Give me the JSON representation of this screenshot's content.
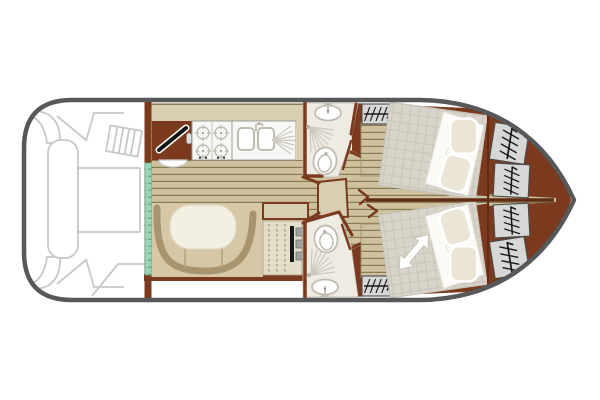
{
  "meta": {
    "title": "Canal boat deck floor plan",
    "view": "top-down",
    "orientation": "bow-right",
    "canvas_width": 600,
    "canvas_height": 400,
    "viewbox": "0 0 600 400"
  },
  "colors": {
    "hull": "#57585a",
    "deck_line": "#c8c8c8",
    "wood": "#7b3a1e",
    "wood_dark": "#5f2b13",
    "floor": "#cdc19e",
    "floor_line": "#7a6f49",
    "teal": "#97d6b8",
    "teal_line": "#3c6e58",
    "backsplash": "#d9cdb2",
    "counter": "#f7f7f5",
    "counter_line": "#9c9c98",
    "fixture": "#c0bcb0",
    "ray": "#cdc9bd",
    "bath": "#efebe3",
    "bench": "#d6c8a7",
    "bench_shadow": "#a8946e",
    "table": "#f3f0e2",
    "table_line": "#ddd6c0",
    "mattress": "#d8d4ca",
    "mattress_line": "#c6c2b8",
    "duvet": "#fbfaf6",
    "pillow": "#ebe5d5",
    "wardrobe": "#d7d7d5",
    "glyph": "#1a1a1a",
    "arrow_edge": "#ccc7ba",
    "white": "#ffffff"
  },
  "areas": {
    "aft_deck": {
      "name": "Aft deck cockpit",
      "features": [
        "corner seat top",
        "corner seat bottom",
        "long bench seat",
        "cockpit table",
        "boarding steps",
        "transom lines"
      ]
    },
    "sliding_door": {
      "name": "Sliding patio door",
      "color_key": "teal"
    },
    "galley": {
      "name": "Galley / helm",
      "features": [
        "helm console with steering wheel",
        "helm seat",
        "hob",
        "double sink",
        "faucet",
        "drainer"
      ],
      "burner_count": 4,
      "sink_basin_count": 2
    },
    "saloon": {
      "name": "Saloon",
      "features": [
        "U-shaped dinette bench",
        "oval dining table",
        "sideboard cabinet with slatted front"
      ]
    },
    "bathroom_top": {
      "name": "Shower room (top)",
      "fixtures": [
        "washbasin",
        "shower",
        "toilet"
      ]
    },
    "bathroom_bottom": {
      "name": "Shower room (bottom)",
      "fixtures": [
        "toilet",
        "shower",
        "washbasin"
      ]
    },
    "corridor": {
      "name": "Central corridor to bow cabins"
    },
    "cabin_top": {
      "name": "Bow cabin (top)",
      "fixtures": [
        "double bed",
        "duvet",
        "wardrobe with hanger rail",
        "access steps"
      ],
      "pillow_count": 2
    },
    "cabin_bottom": {
      "name": "Bow cabin (bottom)",
      "fixtures": [
        "double bed",
        "duvet",
        "wardrobe with hanger rail",
        "access steps",
        "sliding-bed double arrow"
      ],
      "pillow_count": 2
    },
    "bow_storage": {
      "name": "Bow hanging lockers",
      "locker_count": 4
    }
  },
  "icons": [
    "steering-wheel-icon",
    "burner-icon",
    "faucet-icon",
    "sink-basin-icon",
    "drainer-icon",
    "washbasin-icon",
    "shower-icon",
    "toilet-icon",
    "hanger-rail-icon",
    "bed-extension-arrow-icon"
  ]
}
